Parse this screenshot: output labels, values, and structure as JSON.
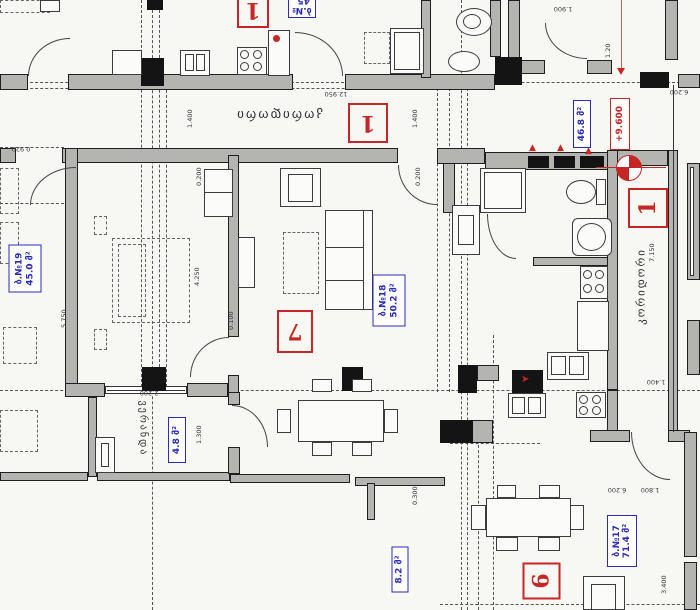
{
  "drawing": {
    "type": "residential-floor-plan",
    "room_labels": {
      "corridor_top": "კორიდორი",
      "corridor_right": "კორიდორი",
      "veranda": "ვერანდა"
    },
    "apartments": {
      "apt19": {
        "num": "ბ.№19",
        "area": "45.0 მ²"
      },
      "apt18": {
        "num": "ბ.№18",
        "area": "50.2 მ²"
      },
      "apt17": {
        "num": "ბ.№17",
        "area": "71.4 მ²"
      },
      "apt_top": {
        "num": "ბ.№",
        "area": "45."
      },
      "hall_area": "46.8 მ²",
      "veranda_area": "4.8 მ²",
      "balcony_area": "8.2 მ²"
    },
    "markers": {
      "elevation": "+9.600",
      "pos_top": "1",
      "pos_corridor": "1",
      "pos_stair": "1",
      "pos_living": "7",
      "pos_apt17": "6"
    },
    "dimensions": [
      "12.950",
      "1.400",
      "1.400",
      "1.900",
      "1.20",
      "6.200",
      "7.150",
      "0.200",
      "4.250",
      "5.750",
      "0.100",
      "2.200",
      "1.300",
      "0.300",
      "1.400",
      "6.200",
      "1.800",
      "3.400",
      "0.920",
      "0.200"
    ],
    "colors": {
      "accent_red": "#c62625",
      "accent_blue": "#2b2bb4",
      "wall_gray": "#b4b4b0"
    }
  }
}
